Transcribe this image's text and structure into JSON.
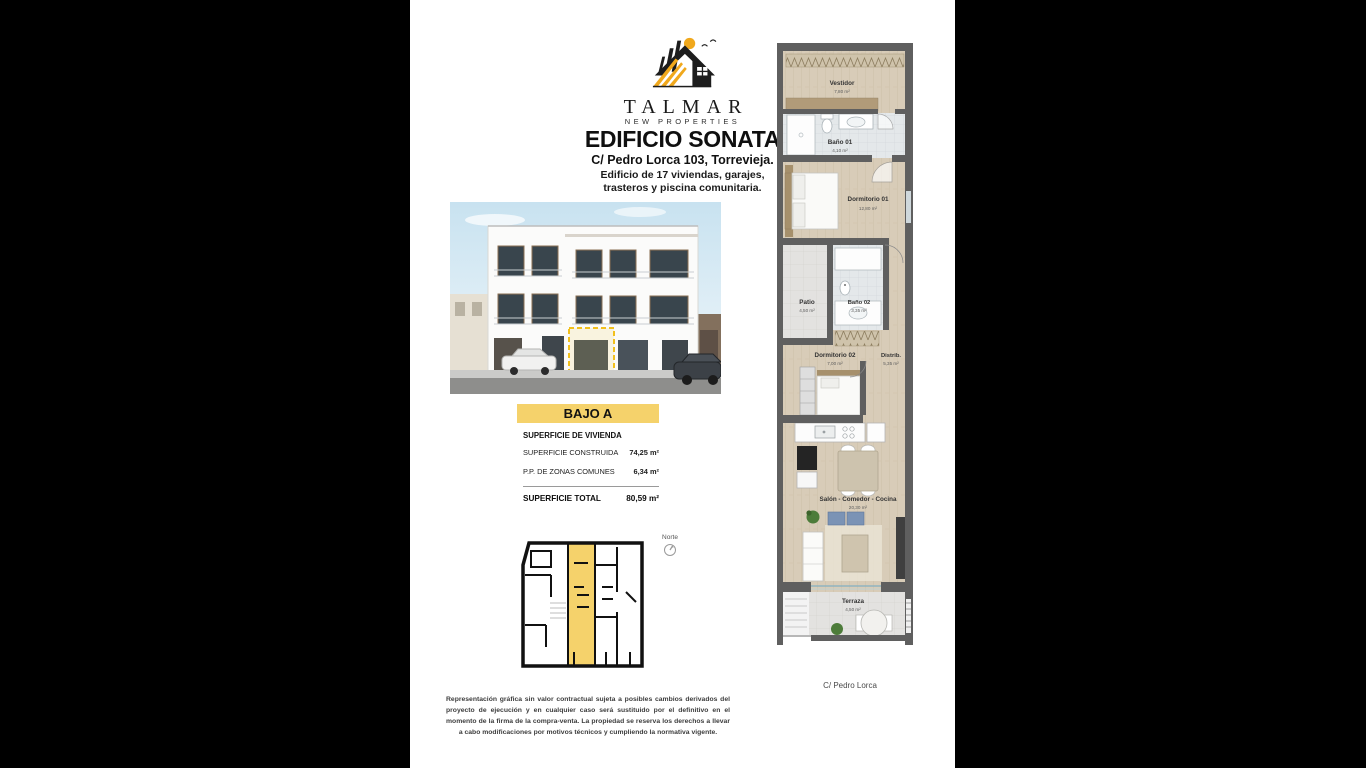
{
  "brand": {
    "name": "TALMAR",
    "tagline": "NEW PROPERTIES"
  },
  "header": {
    "title": "EDIFICIO SONATA",
    "address": "C/ Pedro Lorca 103, Torrevieja.",
    "description_line1": "Edificio de 17 viviendas, garajes,",
    "description_line2": "trasteros y piscina comunitaria."
  },
  "unit_banner": {
    "label": "BAJO A"
  },
  "surface_table": {
    "section_header": "SUPERFICIE DE VIVIENDA",
    "rows": [
      {
        "label": "SUPERFICIE CONSTRUIDA",
        "value": "74,25 m²"
      },
      {
        "label": "P.P. DE ZONAS COMUNES",
        "value": "6,34 m²"
      }
    ],
    "total": {
      "label": "SUPERFICIE TOTAL",
      "value": "80,59 m²"
    }
  },
  "site_plan": {
    "north_label": "Norte"
  },
  "floor_plan": {
    "rooms": [
      {
        "name": "Vestidor",
        "area": "7,80 m²"
      },
      {
        "name": "Baño 01",
        "area": "4,10 m²"
      },
      {
        "name": "Dormitorio 01",
        "area": "12,80 m²"
      },
      {
        "name": "Patio",
        "area": "4,50 m²"
      },
      {
        "name": "Baño 02",
        "area": "3,35 m²"
      },
      {
        "name": "Dormitorio 02",
        "area": "7,00 m²"
      },
      {
        "name": "Distrib.",
        "area": "5,35 m²"
      },
      {
        "name": "Salón - Comedor - Cocina",
        "area": "20,30 m²"
      },
      {
        "name": "Terraza",
        "area": "4,50 m²"
      }
    ],
    "street_label": "C/ Pedro Lorca"
  },
  "disclaimer": "Representación gráfica sin valor contractual sujeta a posibles cambios derivados del proyecto de ejecución y en cualquier caso será sustituido por el definitivo en el momento de la firma de la compra-venta. La propiedad se reserva los derechos a llevar a cabo modificaciones por motivos técnicos y cumpliendo la normativa vigente.",
  "colors": {
    "accent_yellow": "#F5D26B",
    "logo_gold": "#F0A81C",
    "wall_gray": "#5F5F5F",
    "wood_floor": "#D8CCB8",
    "bath_tile": "#E4E8EA",
    "stone_tile": "#E2E2E2",
    "closet_brown": "#B19B79",
    "cushion_blue": "#7B93B5",
    "sky_blue": "#CFE6F2"
  }
}
